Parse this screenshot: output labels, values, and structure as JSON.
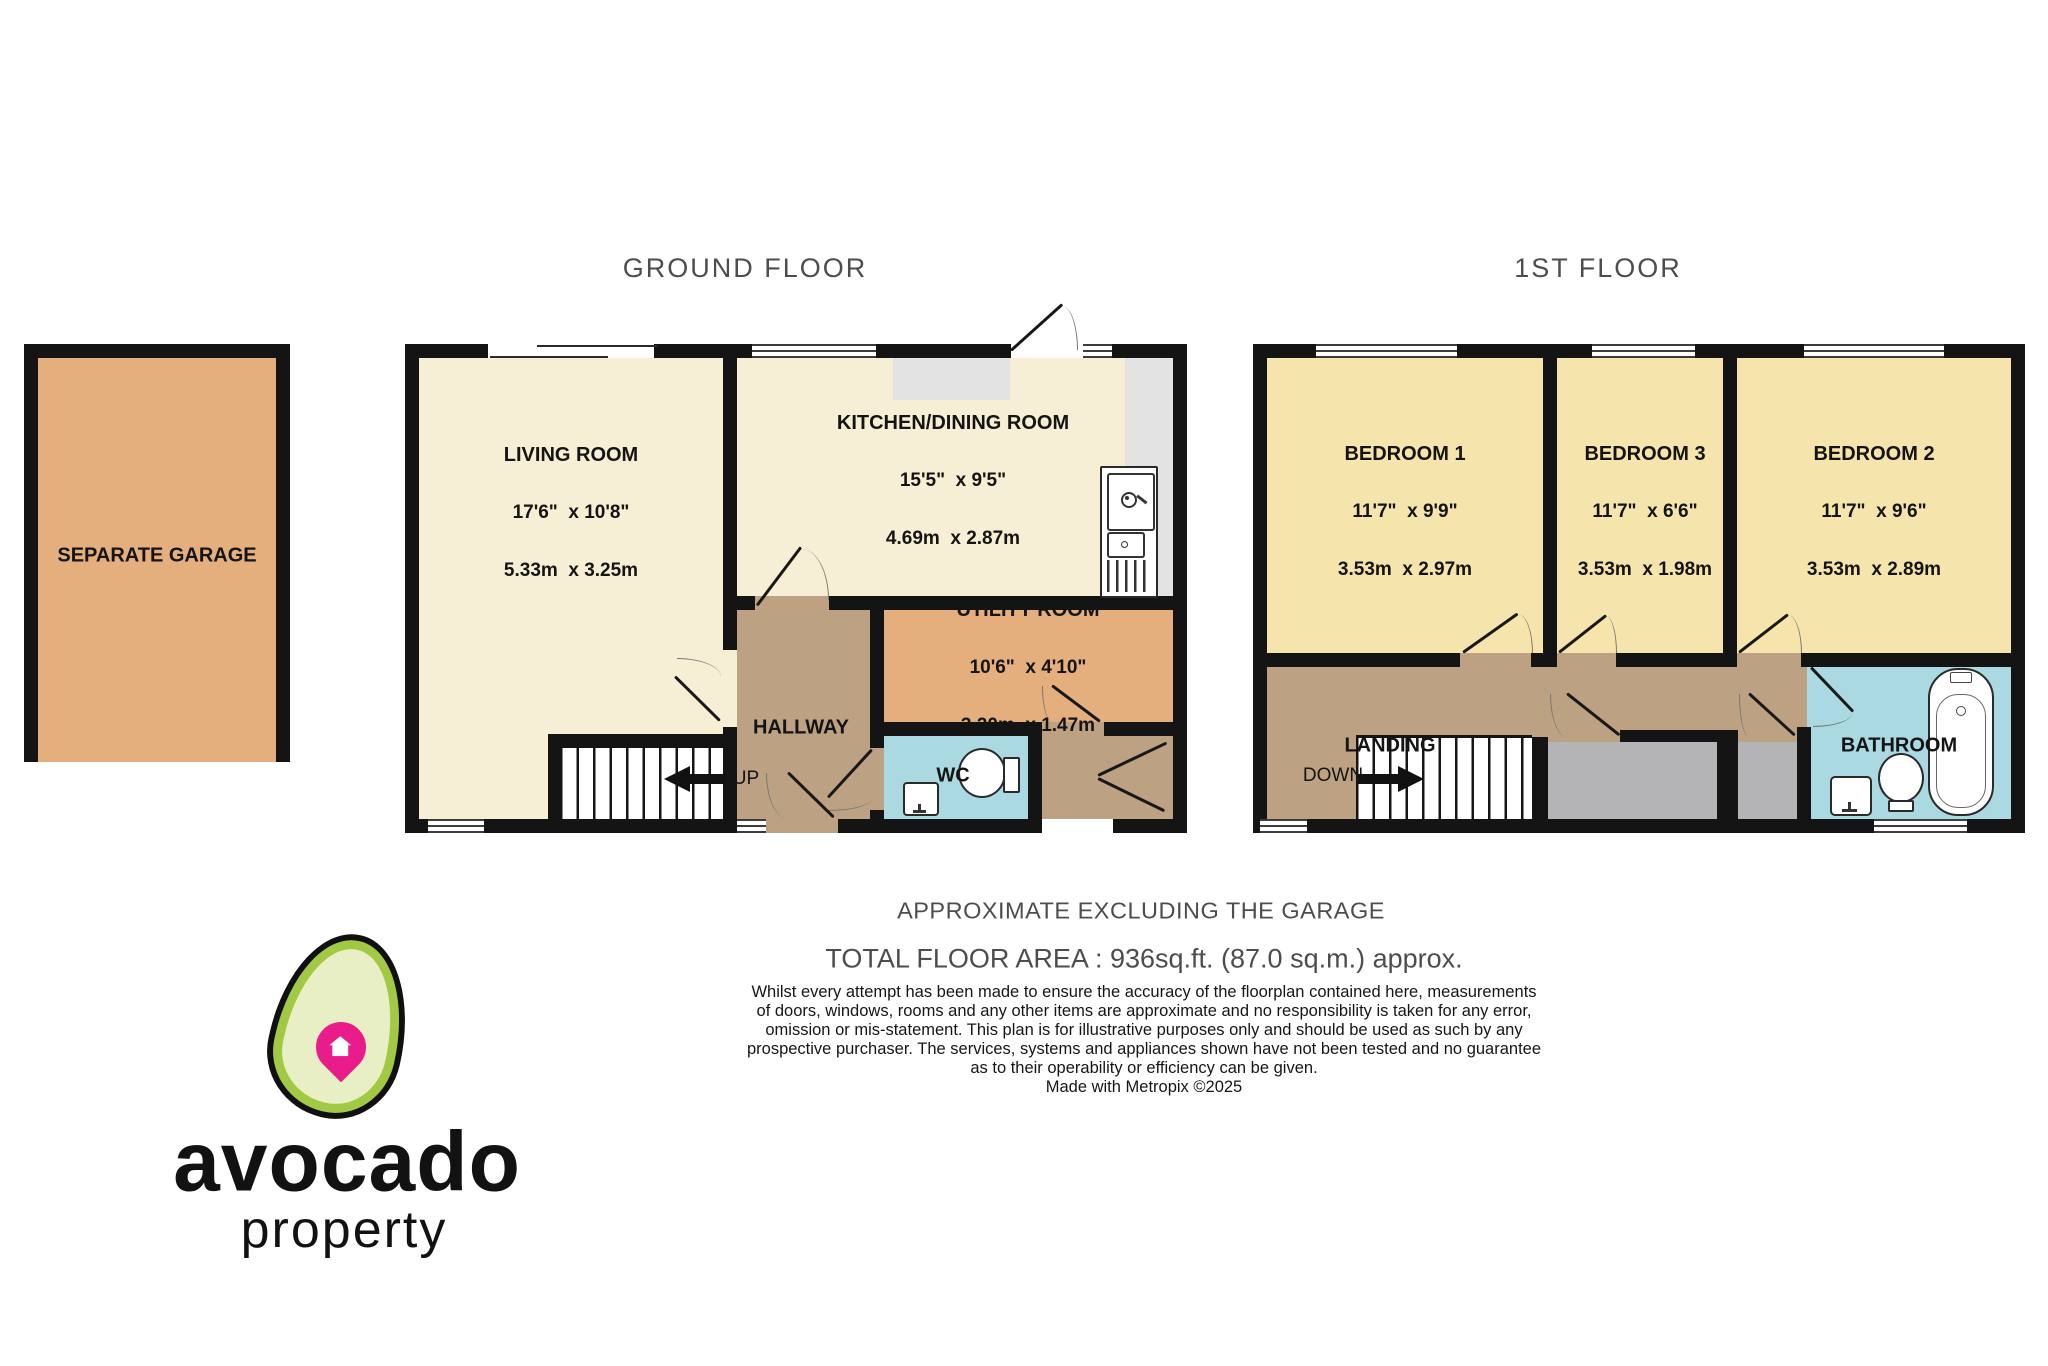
{
  "colors": {
    "wall": "#141414",
    "cream": "#f6efd5",
    "bedroom": "#f5e5ad",
    "orange": "#e5ae7d",
    "tan": "#bda183",
    "blue": "#abd9e2",
    "counter": "#e3e3e4",
    "cupboard": "#b4b4b6",
    "titlegray": "#4d4d4d",
    "ink": "#141414",
    "pin": "#ea1c8b",
    "avocado-rim": "#a2c944",
    "avocado-flesh": "#e9efc4"
  },
  "titles": {
    "ground_floor": "GROUND FLOOR",
    "first_floor": "1ST FLOOR"
  },
  "garage": {
    "label": "SEPARATE GARAGE"
  },
  "ground": {
    "living": {
      "name": "LIVING ROOM",
      "imperial": "17'6\"  x 10'8\"",
      "metric": "5.33m  x 3.25m"
    },
    "kitchen": {
      "name": "KITCHEN/DINING ROOM",
      "imperial": "15'5\"  x 9'5\"",
      "metric": "4.69m  x 2.87m"
    },
    "utility": {
      "name": "UTILITY ROOM",
      "imperial": "10'6\"  x 4'10\"",
      "metric": "3.20m  x 1.47m"
    },
    "hallway": {
      "label": "HALLWAY"
    },
    "wc": {
      "label": "WC"
    },
    "stairs": {
      "label": "UP"
    }
  },
  "first": {
    "bedroom1": {
      "name": "BEDROOM 1",
      "imperial": "11'7\"  x 9'9\"",
      "metric": "3.53m  x 2.97m"
    },
    "bedroom3": {
      "name": "BEDROOM 3",
      "imperial": "11'7\"  x 6'6\"",
      "metric": "3.53m  x 1.98m"
    },
    "bedroom2": {
      "name": "BEDROOM 2",
      "imperial": "11'7\"  x 9'6\"",
      "metric": "3.53m  x 2.89m"
    },
    "landing": {
      "label": "LANDING"
    },
    "bathroom": {
      "label": "BATHROOM"
    },
    "stairs": {
      "label": "DOWN"
    }
  },
  "footer": {
    "approx": "APPROXIMATE EXCLUDING THE GARAGE",
    "total": "TOTAL FLOOR AREA : 936sq.ft. (87.0 sq.m.) approx.",
    "disclaimer": [
      "Whilst every attempt has been made to ensure the accuracy of the floorplan contained here, measurements",
      "of doors, windows, rooms and any other items are approximate and no responsibility is taken for any error,",
      "omission or mis-statement. This plan is for illustrative purposes only and should be used as such by any",
      "prospective purchaser. The services, systems and appliances shown have not been tested and no guarantee",
      "as to their operability or efficiency can be given."
    ],
    "credit": "Made with Metropix ©2025"
  },
  "logo": {
    "brand": "avocado",
    "sub": "property"
  }
}
